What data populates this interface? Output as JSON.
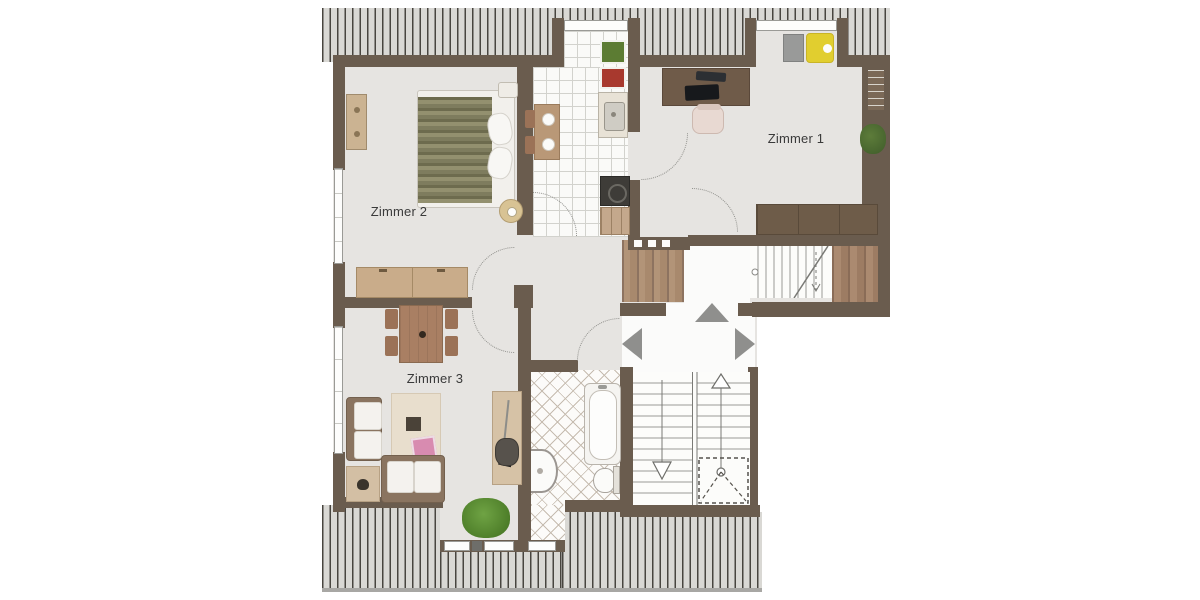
{
  "floorplan": {
    "type": "apartment-floor-plan",
    "rooms": [
      {
        "id": "zimmer-1",
        "label": "Zimmer 1"
      },
      {
        "id": "zimmer-2",
        "label": "Zimmer 2"
      },
      {
        "id": "zimmer-3",
        "label": "Zimmer 3"
      }
    ],
    "colors": {
      "wall": "#6a5c4e",
      "floor": "#e6e4e1",
      "roof_light": "#d9d8d4",
      "roof_dark": "#48453f",
      "wood_light": "#c9ac8a",
      "wood_dark": "#6e5c49",
      "accent_yellow": "#e1ce2f",
      "plant_green": "#4c7a2e",
      "label_text": "#3a3a3a"
    }
  }
}
